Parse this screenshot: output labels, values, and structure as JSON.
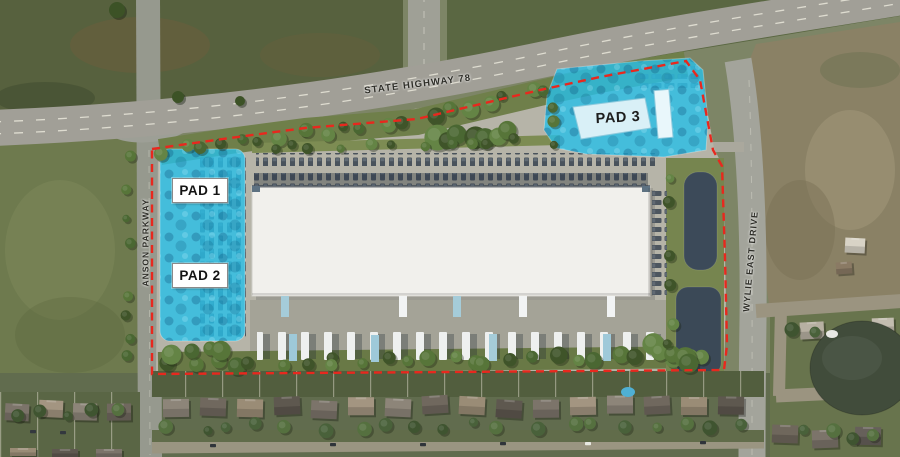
{
  "map": {
    "road_labels": {
      "highway": "STATE HIGHWAY 78",
      "west_road": "ANSON PARKWAY",
      "east_road": "WYLIE EAST DRIVE"
    },
    "pads": [
      {
        "label": "PAD 1"
      },
      {
        "label": "PAD 2"
      },
      {
        "label": "PAD 3"
      }
    ],
    "colors": {
      "pad_highlight": "#28bfe7",
      "site_boundary": "#e8281e",
      "pad_label_bg": "#ffffff",
      "pad_label_text": "#141414"
    }
  }
}
